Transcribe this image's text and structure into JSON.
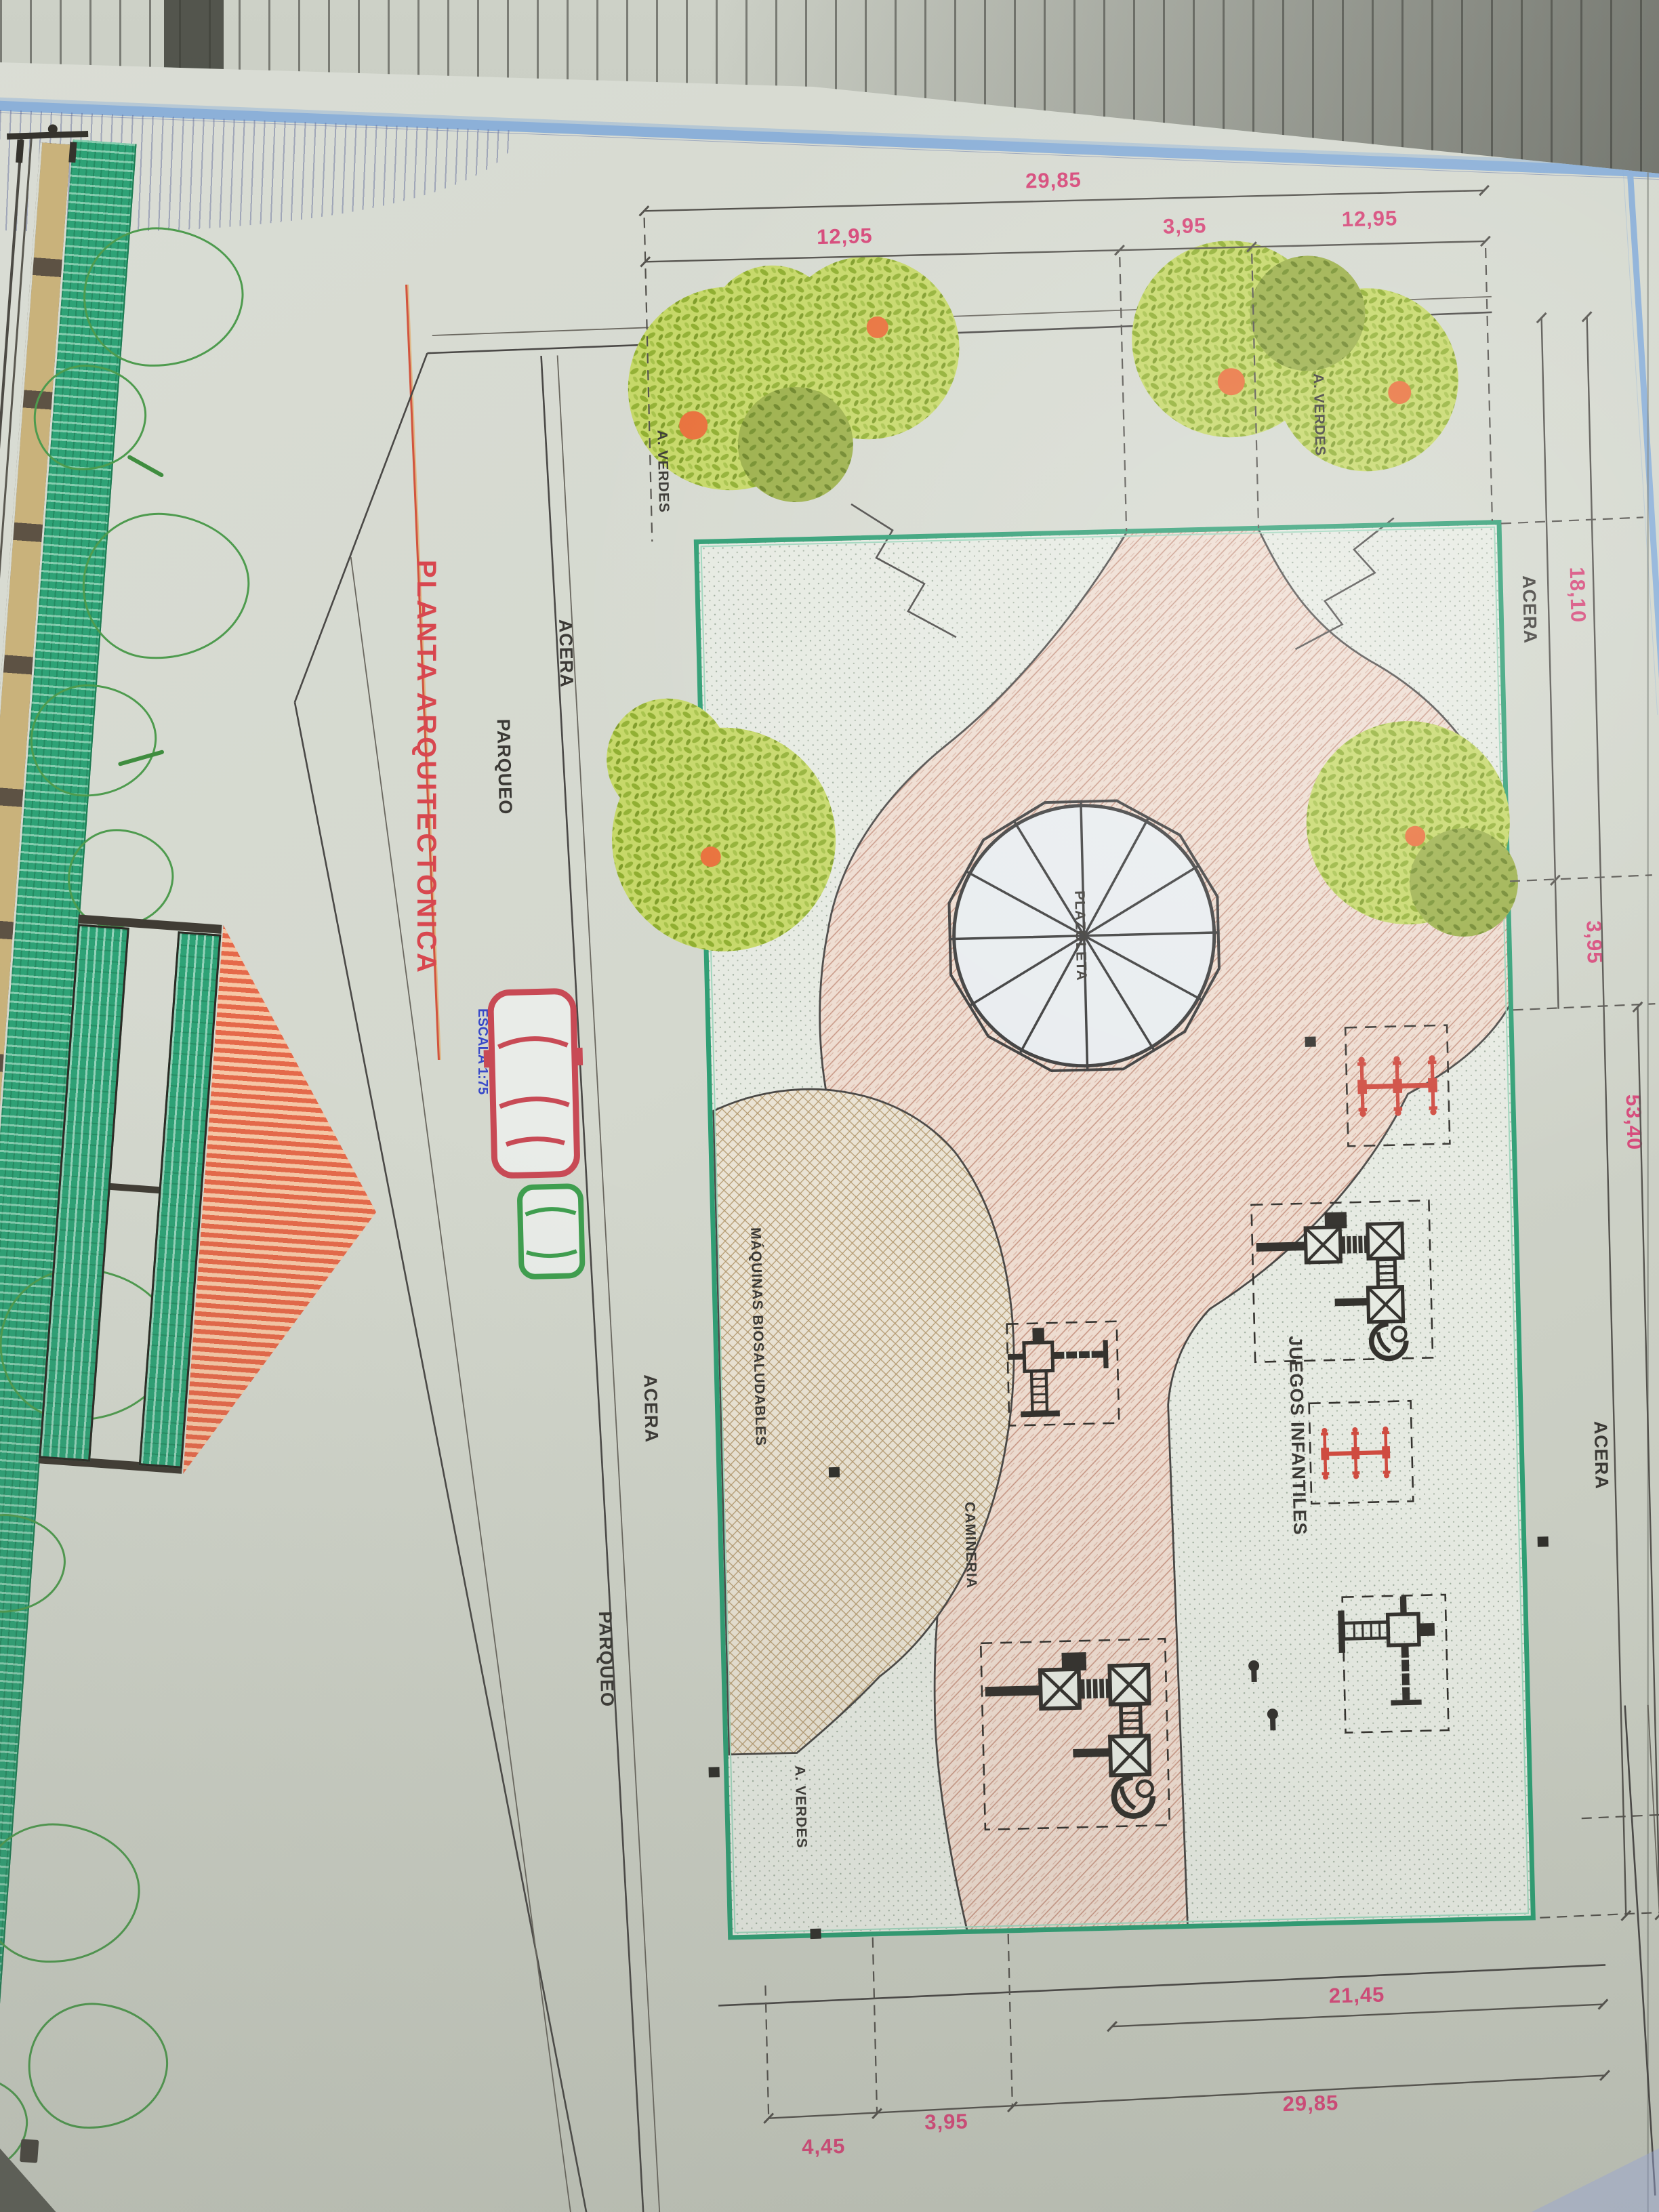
{
  "title": {
    "text": "PLANTA ARQUITECTONICA",
    "scale": "ESCALA 1:75"
  },
  "elevation": {
    "label": "FACHADA FRONTAL",
    "scale": "ESCALA 1:75"
  },
  "labels": {
    "acera": "ACERA",
    "parqueo": "PARQUEO",
    "a_verdes": "A. VERDES",
    "maquinas": "MÁQUINAS BIOSALUDABLES",
    "camineria": "CAMINERIA",
    "juegos": "JUEGOS INFANTILES",
    "plazoleta": "PLAZOLETA"
  },
  "dims": {
    "top_total": "29,85",
    "top_segments": [
      "12,95",
      "3,95",
      "12,95"
    ],
    "right": [
      "18,10",
      "3,95",
      "53,40",
      "31,35"
    ],
    "bottom_inner": "21,45",
    "bottom_segments": [
      "4,45",
      "3,95",
      "29,85"
    ]
  },
  "colors": {
    "title_red": "#d8474f",
    "dim_pink": "#d6497a",
    "scale_blue": "#3748c8",
    "hedge_green": "#2ea276",
    "tree_lime": "#c6d868",
    "path_salmon": "#eedcd0",
    "icon_red": "#cf4b40"
  }
}
